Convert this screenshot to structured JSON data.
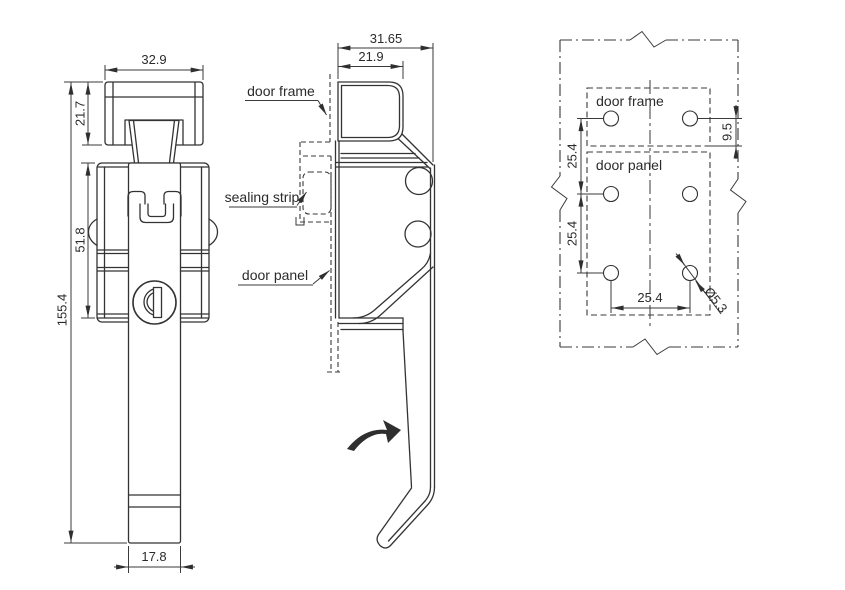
{
  "drawing": {
    "front_view": {
      "dim_cap_width": "32.9",
      "dim_cap_height": "21.7",
      "dim_body_height": "51.8",
      "dim_total_height": "155.4",
      "dim_handle_width": "17.8"
    },
    "side_view": {
      "dim_total_depth": "31.65",
      "dim_channel_depth": "21.9",
      "label_door_frame": "door frame",
      "label_sealing_strip": "sealing strip",
      "label_door_panel": "door panel"
    },
    "mounting_view": {
      "label_door_frame": "door frame",
      "label_door_panel": "door panel",
      "dim_frame_hole_offset": "9.5",
      "dim_vertical_pitch_upper": "25.4",
      "dim_vertical_pitch_lower": "25.4",
      "dim_horizontal_pitch": "25.4",
      "dim_hole_diameter": "Ø5.3"
    },
    "colors": {
      "line": "#333333",
      "dimension": "#3a3a3a",
      "background": "#ffffff"
    }
  }
}
